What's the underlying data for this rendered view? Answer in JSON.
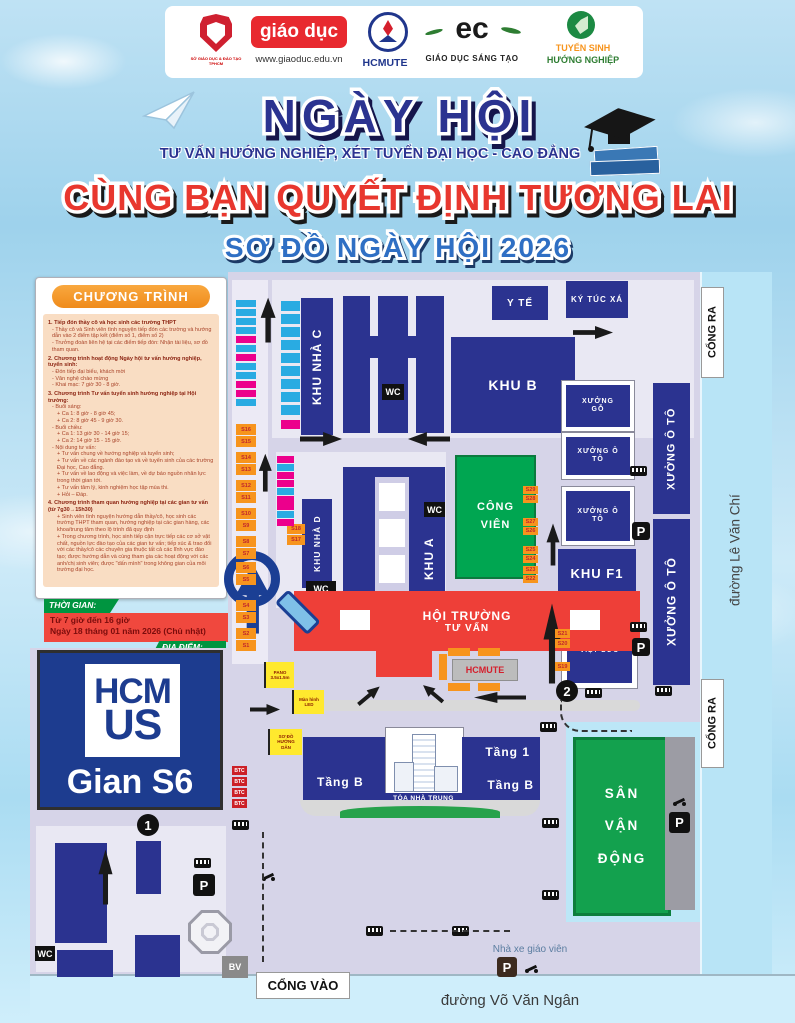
{
  "header": {
    "logos": [
      {
        "caption": "SỞ GIÁO DỤC & ĐÀO TẠO TPHCM"
      },
      {
        "label": "giáo dục",
        "caption": "www.giaoduc.edu.vn"
      },
      {
        "label": "HCMUTE"
      },
      {
        "label": "ec",
        "caption": "GIÁO DỤC SÁNG TẠO"
      },
      {
        "line1": "TUYỂN SINH",
        "line2": "HƯỚNG NGHIỆP"
      }
    ]
  },
  "banner": {
    "title": "NGÀY HỘI",
    "subtitle": "TƯ VẤN HƯỚNG NGHIỆP, XÉT TUYỂN ĐẠI HỌC - CAO ĐẲNG",
    "slogan": "CÙNG BẠN QUYẾT ĐỊNH TƯƠNG LAI",
    "map_title": "SƠ ĐỒ NGÀY HỘI 2026"
  },
  "program": {
    "heading": "CHƯƠNG TRÌNH",
    "sections": [
      {
        "style": "h",
        "text": "1. Tiếp đón thầy cô và học sinh các trường THPT"
      },
      {
        "style": "p",
        "text": "- Thầy cô và Sinh viên tình nguyện tiếp đón các trường và hướng dẫn vào 2 điểm tập kết (điểm số 1, điểm số 2)"
      },
      {
        "style": "p",
        "text": "- Trưởng đoàn liên hệ tại các điểm tiếp đón: Nhận tài liệu, sơ đồ tham quan."
      },
      {
        "style": "h",
        "text": "2. Chương trình hoạt động Ngày hội tư vấn hướng nghiệp, tuyển sinh:"
      },
      {
        "style": "p",
        "text": "- Đón tiếp đại biểu, khách mời"
      },
      {
        "style": "p",
        "text": "- Văn nghệ chào mừng"
      },
      {
        "style": "p",
        "text": "- Khai mạc: 7 giờ 30 - 8 giờ."
      },
      {
        "style": "h",
        "text": "3. Chương trình Tư vấn tuyển sinh hướng nghiệp tại Hội trường:"
      },
      {
        "style": "p",
        "text": "- Buổi sáng:"
      },
      {
        "style": "p2",
        "text": "+ Ca 1: 8 giờ - 8 giờ 45;"
      },
      {
        "style": "p2",
        "text": "+ Ca 2: 8 giờ 45 - 9 giờ 30."
      },
      {
        "style": "p",
        "text": "- Buổi chiều:"
      },
      {
        "style": "p2",
        "text": "+ Ca 1: 13 giờ 30 - 14 giờ 15;"
      },
      {
        "style": "p2",
        "text": "+ Ca 2: 14 giờ 15 - 15 giờ."
      },
      {
        "style": "p",
        "text": "- Nội dung tư vấn:"
      },
      {
        "style": "p2",
        "text": "+ Tư vấn chung về hướng nghiệp và tuyển sinh;"
      },
      {
        "style": "p2",
        "text": "+ Tư vấn về các ngành đào tạo và về tuyển sinh của các trường Đại học, Cao đẳng."
      },
      {
        "style": "p2",
        "text": "+ Tư vấn về lao động và việc làm, về dự báo nguồn nhân lực trong thời gian tới."
      },
      {
        "style": "p2",
        "text": "+ Tư vấn tâm lý, kinh nghiệm học tập mùa thi."
      },
      {
        "style": "p2",
        "text": "+ Hỏi – Đáp."
      },
      {
        "style": "h",
        "text": "4. Chương trình tham quan hướng nghiệp tại các gian tư vấn (từ 7g30→15h30)"
      },
      {
        "style": "p2",
        "text": "+ Sinh viên tình nguyện hướng dẫn thầy/cô, học sinh các trường THPT tham quan, hướng nghiệp tại các gian hàng, các khoa/trung tâm theo lộ trình đã quy định"
      },
      {
        "style": "p2",
        "text": "+ Trong chương trình, học sinh tiếp cận trực tiếp các cơ sở vật chất, nguồn lực đào tạo của các gian tư vấn; tiếp xúc & trao đổi với các thầy/cô các chuyên gia thuộc tất cả các lĩnh vực đào tạo; được hướng dẫn và cùng tham gia các hoạt động với các anh/chị sinh viên; được \"dấn mình\" trong không gian của môi trường đại học."
      }
    ]
  },
  "time_box": {
    "label": "THỜI GIAN:",
    "line1": "Từ 7 giờ đến 16 giờ",
    "line2": "Ngày 18 tháng 01 năm 2026 (Chủ nhật)"
  },
  "location_box": {
    "label": "ĐỊA ĐIỂM:"
  },
  "callout": {
    "hcm": "HCM",
    "us": "US",
    "booth": "Gian S6"
  },
  "map": {
    "buildings": {
      "khu_nha_c": "KHU NHÀ C",
      "khu_b": "KHU B",
      "y_te": "Y TẾ",
      "ky_tuc_xa": "KÝ TÚC XÁ",
      "xuong_go": "XƯỞNG GỖ",
      "xuong_o_to": "XƯỞNG Ô TÔ",
      "khu_f1": "KHU F1",
      "xuong_viet_duc": "XƯỞNG VIỆT ĐỨC",
      "khu_nha_d": "KHU NHÀ D",
      "khu_a": "KHU A",
      "cong_vien": "CÔNG VIÊN",
      "hoi_truong_1": "HỘI TRƯỜNG",
      "hoi_truong_2": "TƯ VẤN",
      "hcmute": "HCMUTE",
      "tang_1": "Tầng 1",
      "tang_b": "Tầng B",
      "toa_nha_trung_tam": "TÒA NHÀ TRUNG TÂM",
      "san_van_dong": "SÂN VẬN ĐỘNG"
    },
    "labels": {
      "cong_ra": "CỔNG RA",
      "cong_vao": "CỔNG VÀO",
      "wc": "WC",
      "bv": "BV",
      "p": "P",
      "btc": "BTC",
      "road_right": "đường Lê Văn Chí",
      "road_bottom": "đường Võ Văn Ngân",
      "teacher_parking": "Nhà xe giáo viên",
      "pano": "PANO 3.5x1.5m",
      "led": "Màn hình LED",
      "so_do": "SƠ ĐỒ HƯỚNG DẪN",
      "point1": "1",
      "point2": "2"
    },
    "booths_left": [
      "S16",
      "S15",
      "S14",
      "S13",
      "S12",
      "S11",
      "S10",
      "S9",
      "S8",
      "S7",
      "S6",
      "S5",
      "S4",
      "S3",
      "S2",
      "S1"
    ],
    "booths_right": [
      "S29",
      "S28",
      "S27",
      "S26",
      "S25",
      "S24",
      "S23",
      "S22"
    ],
    "booths_vietduc": [
      "S21",
      "S20",
      "S19"
    ],
    "booths_khud": [
      "S18",
      "S17"
    ]
  },
  "colors": {
    "building_navy": "#2b3390",
    "hall_red": "#ee3f38",
    "park_green": "#00a651",
    "booth_orange": "#f7941d",
    "booth_cyan": "#29abe2",
    "booth_pink": "#ec008c",
    "map_ground": "#d6d4e8",
    "road_blue": "#b8e4f6"
  }
}
